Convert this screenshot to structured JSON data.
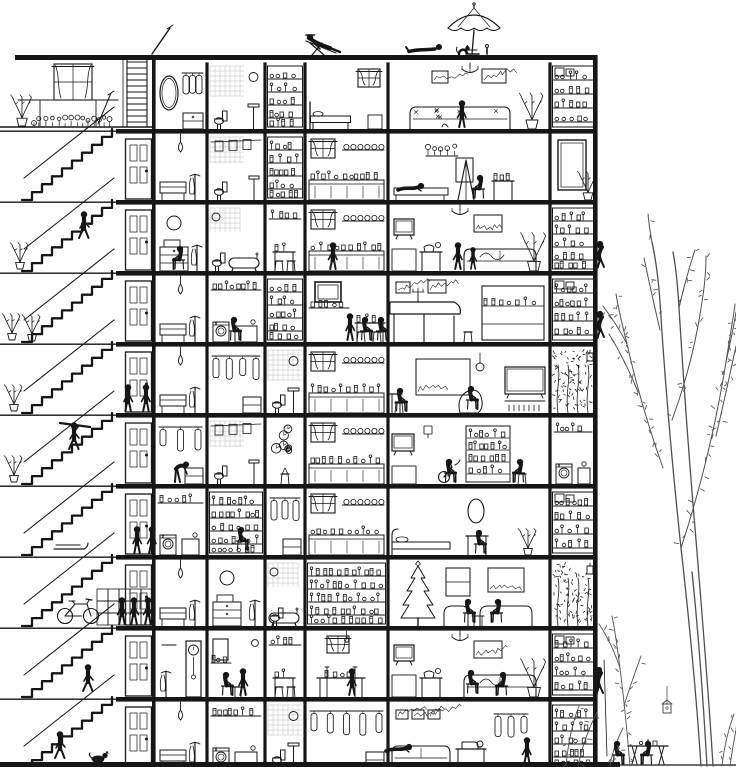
{
  "title": "Cross-section illustration of a ten-story apartment building with external staircase, furnished rooms, roof sunbathers and a tree",
  "palette": {
    "bg": "#ffffff",
    "ink": "#161616",
    "tree": "#4f4f4f",
    "tile": "#b7b7b7"
  },
  "canvas": {
    "w": 736,
    "h": 767
  },
  "building": {
    "roof_y": 55,
    "ground_y": 762,
    "left_wall_x": 152,
    "right_wall_x": 593,
    "floor_ys": [
      58,
      129,
      200,
      271,
      342,
      413,
      484,
      555,
      626,
      697
    ],
    "floor_height": 71,
    "room_columns": [
      154,
      207,
      265,
      305,
      388,
      550,
      596
    ],
    "floors": [
      {
        "rooms": [
          "vanity",
          "bathroom",
          "pantry",
          "bedroom",
          "living",
          "shelves"
        ]
      },
      {
        "rooms": [
          "hall",
          "bathroom2",
          "pantry",
          "kitchen",
          "studio",
          "mirror"
        ]
      },
      {
        "rooms": [
          "dresser",
          "bathtub",
          "kitchen2",
          "kitchen",
          "tvroom",
          "pantry"
        ]
      },
      {
        "rooms": [
          "hall",
          "laundry",
          "pantry",
          "bar",
          "piano",
          "shelves"
        ]
      },
      {
        "rooms": [
          "hall",
          "wardrobe",
          "bathroom",
          "kitchen",
          "study",
          "plants"
        ]
      },
      {
        "rooms": [
          "wardrobe",
          "bathroom2",
          "clocks",
          "kitchen",
          "rec",
          "laundry"
        ]
      },
      {
        "rooms": [
          "laundry",
          "pantry",
          "wardrobe",
          "kitchen",
          "bedroom2",
          "shelves"
        ]
      },
      {
        "rooms": [
          "hall",
          "dresser",
          "bathtub",
          "pantry",
          "xmas",
          "plants"
        ]
      },
      {
        "rooms": [
          "hallclock",
          "barber",
          "kitchen2",
          "dining",
          "tvroom",
          "shelves"
        ]
      },
      {
        "rooms": [
          "hall",
          "laundry",
          "bathroom",
          "wardrobe",
          "lounge",
          "pantry"
        ]
      }
    ],
    "door_floors": [
      1,
      2,
      3,
      4,
      5,
      6,
      7,
      8,
      9
    ],
    "ladder": {
      "x1": 127,
      "x2": 147,
      "top": 58,
      "bottom": 127
    },
    "antenna": [
      152,
      54,
      170,
      28
    ]
  },
  "staircase": {
    "flight_top_x": 112,
    "flight_bottom_x": 22,
    "steps": 9,
    "landing_items": [
      {
        "t": "plant",
        "x": 20,
        "y": 269
      },
      {
        "t": "plant",
        "x": 12,
        "y": 340
      },
      {
        "t": "plant",
        "x": 32,
        "y": 341
      },
      {
        "t": "plant",
        "x": 14,
        "y": 411
      },
      {
        "t": "plant",
        "x": 14,
        "y": 482
      },
      {
        "t": "sled",
        "x": 54,
        "y": 551
      },
      {
        "t": "bicycle",
        "x": 78,
        "y": 624
      },
      {
        "t": "crates",
        "x": 97,
        "y": 625
      }
    ]
  },
  "terrace": {
    "window": [
      54,
      64,
      38,
      36
    ],
    "shelf": [
      18,
      100,
      118
    ],
    "broom": [
      98,
      124,
      111,
      93
    ],
    "flowers_row": [
      34,
      112,
      123
    ],
    "tall_plant": [
      22,
      122
    ]
  },
  "roof": {
    "umbrella": {
      "x": 474,
      "top": 8,
      "half_w": 26
    },
    "bottle_x": 487
  },
  "people": [
    {
      "x": 318,
      "y": 55,
      "pose": "lounge"
    },
    {
      "x": 425,
      "y": 54,
      "pose": "lie"
    },
    {
      "x": 464,
      "y": 54,
      "pose": "cat"
    },
    {
      "x": 462,
      "y": 127,
      "pose": "stand"
    },
    {
      "x": 412,
      "y": 194,
      "pose": "recline"
    },
    {
      "x": 481,
      "y": 198,
      "pose": "sit",
      "flip": 1
    },
    {
      "x": 84,
      "y": 238,
      "pose": "walk"
    },
    {
      "x": 181,
      "y": 269,
      "pose": "sit",
      "flip": 1
    },
    {
      "x": 333,
      "y": 269,
      "pose": "stand"
    },
    {
      "x": 458,
      "y": 269,
      "pose": "stand"
    },
    {
      "x": 473,
      "y": 269,
      "pose": "stand",
      "flip": 1,
      "s": 0.82
    },
    {
      "x": 601,
      "y": 268,
      "pose": "climb"
    },
    {
      "x": 233,
      "y": 340,
      "pose": "sit"
    },
    {
      "x": 364,
      "y": 340,
      "pose": "sit"
    },
    {
      "x": 380,
      "y": 340,
      "pose": "sit"
    },
    {
      "x": 350,
      "y": 340,
      "pose": "stand",
      "flip": 1
    },
    {
      "x": 601,
      "y": 338,
      "pose": "climb"
    },
    {
      "x": 128,
      "y": 411,
      "pose": "stand",
      "flip": 1
    },
    {
      "x": 146,
      "y": 411,
      "pose": "stand"
    },
    {
      "x": 74,
      "y": 449,
      "pose": "carry"
    },
    {
      "x": 399,
      "y": 411,
      "pose": "sit"
    },
    {
      "x": 470,
      "y": 409,
      "pose": "sit"
    },
    {
      "x": 179,
      "y": 482,
      "pose": "stoop"
    },
    {
      "x": 448,
      "y": 482,
      "pose": "sit"
    },
    {
      "x": 521,
      "y": 482,
      "pose": "sit",
      "flip": 1
    },
    {
      "x": 137,
      "y": 553,
      "pose": "stand",
      "flip": 1
    },
    {
      "x": 152,
      "y": 553,
      "pose": "stand"
    },
    {
      "x": 240,
      "y": 550,
      "pose": "sit"
    },
    {
      "x": 478,
      "y": 553,
      "pose": "sit"
    },
    {
      "x": 122,
      "y": 624,
      "pose": "stand"
    },
    {
      "x": 134,
      "y": 624,
      "pose": "stand",
      "flip": 1
    },
    {
      "x": 148,
      "y": 624,
      "pose": "stand"
    },
    {
      "x": 467,
      "y": 622,
      "pose": "sit"
    },
    {
      "x": 499,
      "y": 622,
      "pose": "sit",
      "flip": 1
    },
    {
      "x": 88,
      "y": 691,
      "pose": "walk"
    },
    {
      "x": 225,
      "y": 695,
      "pose": "sit"
    },
    {
      "x": 243,
      "y": 695,
      "pose": "stand",
      "flip": 1
    },
    {
      "x": 352,
      "y": 695,
      "pose": "stand"
    },
    {
      "x": 470,
      "y": 693,
      "pose": "sit"
    },
    {
      "x": 504,
      "y": 695,
      "pose": "sit",
      "flip": 1
    },
    {
      "x": 600,
      "y": 694,
      "pose": "climb",
      "rope": 1
    },
    {
      "x": 60,
      "y": 758,
      "pose": "walk"
    },
    {
      "x": 400,
      "y": 755,
      "pose": "recline"
    },
    {
      "x": 527,
      "y": 764,
      "pose": "stand"
    },
    {
      "x": 98,
      "y": 764,
      "pose": "dog"
    },
    {
      "x": 616,
      "y": 764,
      "pose": "sit"
    },
    {
      "x": 649,
      "y": 764,
      "pose": "sit",
      "flip": 1
    }
  ],
  "outdoor": {
    "table": {
      "x": 628,
      "y": 764,
      "w": 40
    }
  },
  "tree": {
    "trunks": [
      "M701,766C697,705 690,628 681,548C673,473 665,383 660,302C658,272 655,256 652,242",
      "M713,766C709,700 702,612 695,528C689,458 683,372 679,308C678,290 676,268 673,252",
      "M707,766C704,714 700,648 692,572"
    ],
    "branches": [
      "M681,548C700,490 715,430 726,362C729,342 733,320 735,304",
      "M716,436C723,406 730,374 736,346",
      "M726,362C730,344 734,326 736,312",
      "M663,468C648,426 637,388 627,344C622,324 618,306 616,294",
      "M638,392C629,370 619,350 609,334",
      "M672,420C686,382 696,344 702,302C705,284 706,268 706,256",
      "M660,330C654,304 649,282 644,258",
      "M652,242C650,232 649,224 648,214",
      "M679,308C684,286 689,268 695,250",
      "M627,344C620,330 612,318 603,306"
    ],
    "sapling": [
      "M630,766C627,730 624,700 620,668C617,646 615,630 612,616",
      "M620,668C614,650 607,636 599,624",
      "M624,706C630,686 636,670 641,656"
    ],
    "bushes": [
      "M566,766C568,744 572,724 579,706",
      "M578,766C582,746 589,728 597,712",
      "M610,766C612,752 617,740 623,728",
      "M722,766C724,748 728,730 734,714",
      "M730,766C732,752 734,740 736,730"
    ],
    "birdhouse": [
      663,
      704
    ]
  }
}
